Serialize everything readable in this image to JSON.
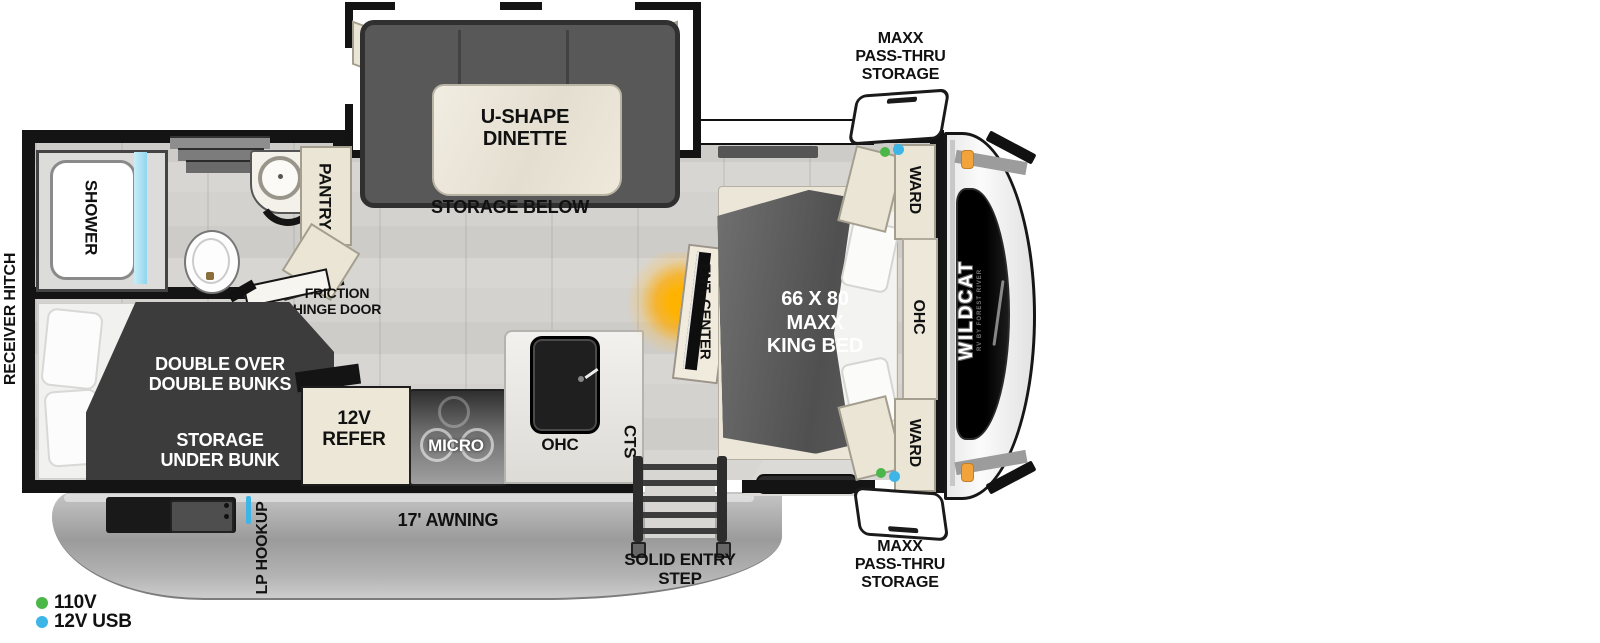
{
  "title": "Travel trailer floorplan",
  "brand": {
    "logo": "WILDCAT",
    "logo_sub": "RV BY FOREST RIVER"
  },
  "exterior": {
    "receiver_hitch": "RECEIVER HITCH",
    "storage_top": {
      "l1": "MAXX",
      "l2": "PASS-THRU",
      "l3": "STORAGE"
    },
    "storage_bottom": {
      "l1": "MAXX",
      "l2": "PASS-THRU",
      "l3": "STORAGE"
    },
    "awning": "17' AWNING",
    "entry_step": {
      "l1": "SOLID ENTRY",
      "l2": "STEP"
    },
    "lp_hookup": "LP HOOKUP"
  },
  "interior": {
    "shower": "SHOWER",
    "pantry": "PANTRY",
    "dinette": {
      "l1": "U-SHAPE",
      "l2": "DINETTE"
    },
    "dinette_storage": "STORAGE BELOW",
    "friction_door": {
      "l1": "FRICTION",
      "l2": "HINGE DOOR"
    },
    "bunks": {
      "l1": "DOUBLE OVER",
      "l2": "DOUBLE BUNKS"
    },
    "bunk_storage": {
      "l1": "STORAGE",
      "l2": "UNDER BUNK"
    },
    "refer": {
      "l1": "12V",
      "l2": "REFER"
    },
    "micro": "MICRO",
    "ohc_kitchen": "OHC",
    "cts": "CTS",
    "ent_center": "ENT. CENTER",
    "bed": {
      "l1": "66 X 80",
      "l2": "MAXX",
      "l3": "KING BED"
    },
    "ward_top": "WARD",
    "ward_bottom": "WARD",
    "ohc_bedroom": "OHC"
  },
  "legend": {
    "items": [
      {
        "label": "110V",
        "color": "#4bb749"
      },
      {
        "label": "12V USB",
        "color": "#3db5e6"
      }
    ]
  },
  "colors": {
    "wall": "#141414",
    "cabinet": "#eae5d4",
    "dark_furniture": "#3b3b3b",
    "dinette_bench": "#585858",
    "floor": "#d4d2cf",
    "awning_gray": "#a5a5a5",
    "accent_orange": "#f2a33c",
    "fireplace_glow": "#ffb300",
    "shower_glass_blue": "#a8dff2",
    "legend_green": "#4bb749",
    "legend_blue": "#3db5e6"
  }
}
